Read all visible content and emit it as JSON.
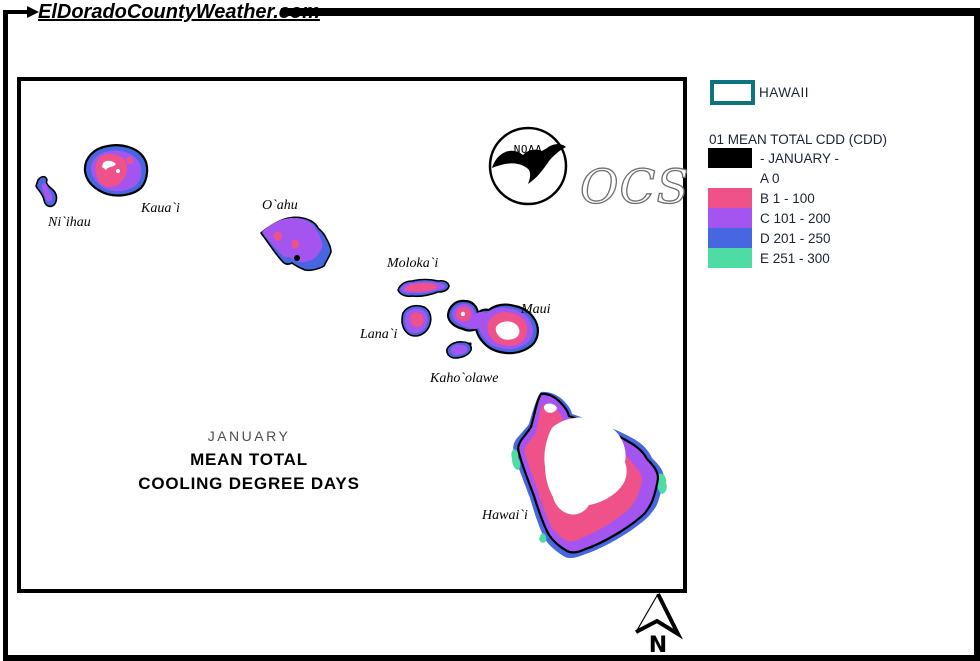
{
  "palette": {
    "zone_b_pink": "#ee5288",
    "zone_c_purple": "#a455f0",
    "zone_d_blue": "#4667e0",
    "zone_e_green": "#4edca4",
    "coast": "#000000",
    "legend_box_teal": "#0b7480",
    "text_dark": "#1a2430"
  },
  "header": {
    "site_title": "ElDoradoCountyWeather.com"
  },
  "legend": {
    "region_label": "HAWAII",
    "title": "01 MEAN TOTAL CDD (CDD)",
    "rows": [
      {
        "label": "- JANUARY -",
        "swatch": "#000000"
      },
      {
        "label": "A 0",
        "swatch": ""
      },
      {
        "label": "B 1 - 100",
        "swatch": "#ee5288"
      },
      {
        "label": "C 101 - 200",
        "swatch": "#a455f0"
      },
      {
        "label": "D 201 - 250",
        "swatch": "#4667e0"
      },
      {
        "label": "E 251 - 300",
        "swatch": "#4edca4"
      }
    ]
  },
  "map": {
    "title_line1": "JANUARY",
    "title_line2": "MEAN TOTAL",
    "title_line3": "COOLING DEGREE DAYS",
    "islands": {
      "niihau": "Ni`ihau",
      "kauai": "Kaua`i",
      "oahu": "O`ahu",
      "molokai": "Moloka`i",
      "lanai": "Lana`i",
      "maui": "Maui",
      "kahoolawe": "Kaho`olawe",
      "hawaii": "Hawai`i"
    },
    "logo": {
      "noaa": "NOAA",
      "ocs": "OCS"
    },
    "compass": {
      "north_label": "N"
    }
  }
}
